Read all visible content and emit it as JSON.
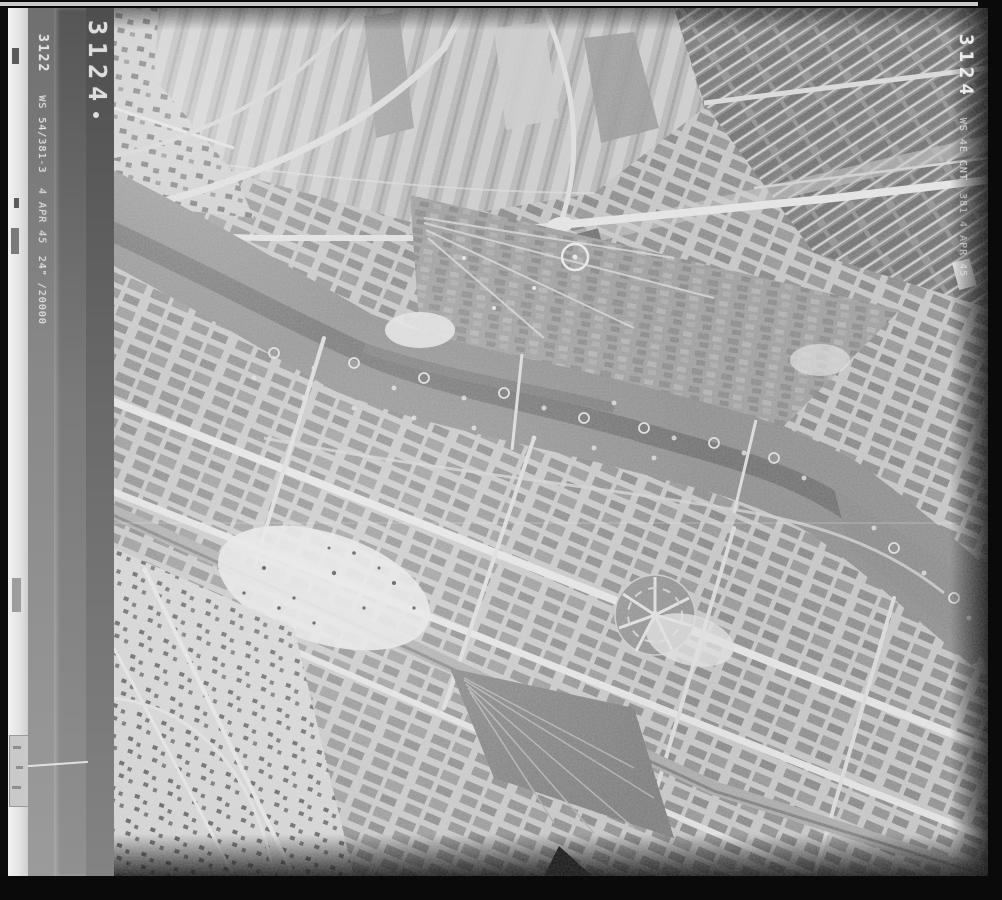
{
  "film": {
    "edge_frame_number": "3124",
    "titling_strip": {
      "frame_number": "3122",
      "prefix": "WS",
      "sortie_reference": "54/381-3",
      "date": "4 APR 45",
      "focal_length": "24\"",
      "scale": "/20000"
    },
    "right_marking": {
      "frame_number": "3124",
      "line1": "WS 4E CNT",
      "line2": "381 4 APR 45"
    },
    "palette": {
      "border_black": "#0a0a0a",
      "film_gray": "#6e6e6e",
      "titling_white": "#e4e4e4",
      "photo_light": "#c8c8c8",
      "photo_midtone": "#9a9a9a",
      "photo_dark": "#6f6f6f"
    }
  },
  "photo": {
    "subject": "Vertical aerial reconnaissance photograph of a city on a winding river, with striped farm fields to the north, dense bomb-damaged street blocks to the south, crater rings along the river meadows, a circular garden feature, a radial star-shaped park and a railway yard"
  }
}
